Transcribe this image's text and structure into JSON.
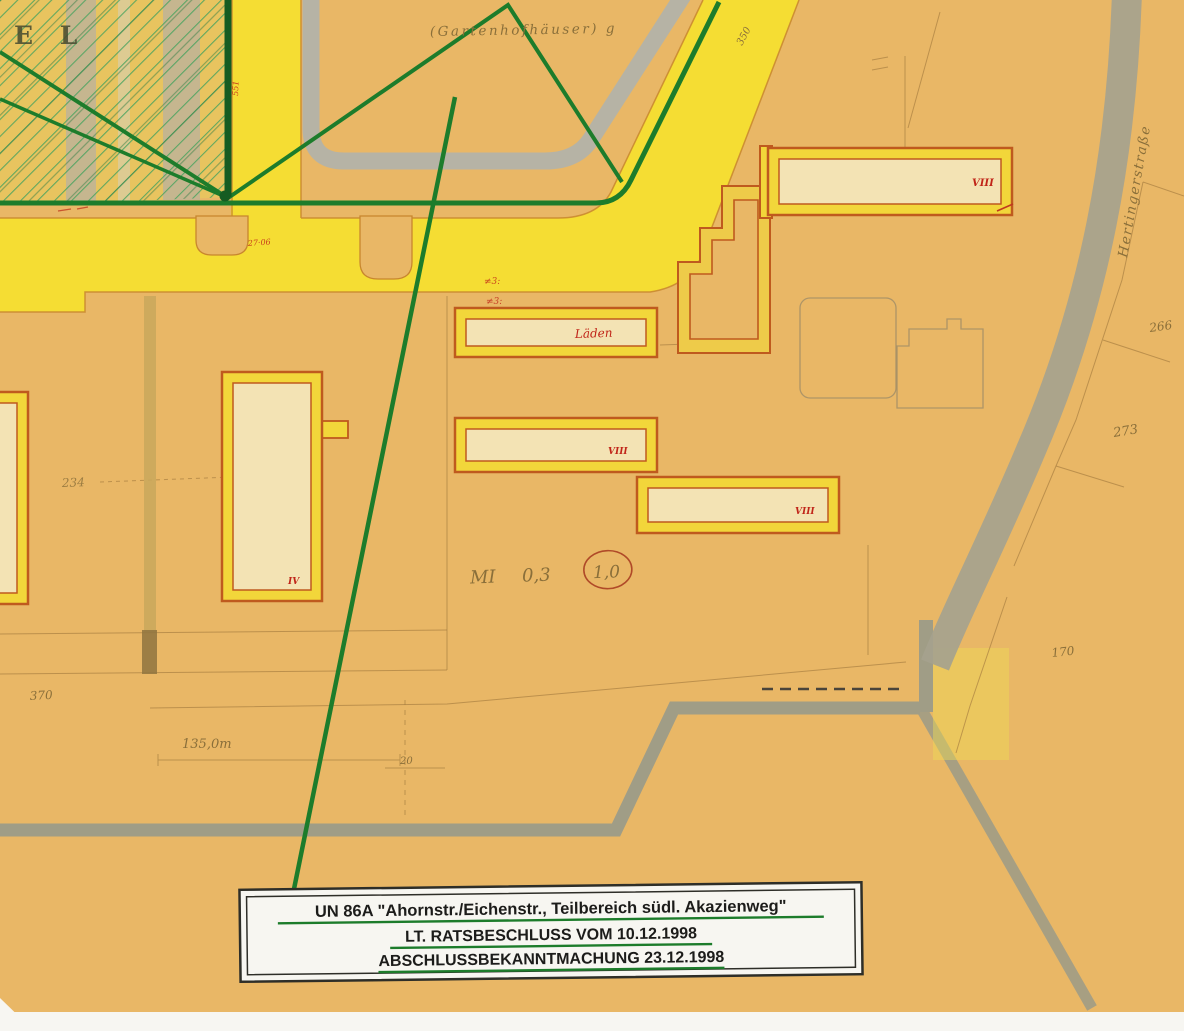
{
  "map": {
    "background": "#e9b766",
    "road_color": "#f5dd33",
    "green_line_color": "#1d7c2b",
    "gray_band_color": "#b6b3a5",
    "boundary_color": "#a09d86",
    "building_outline_color": "#bf5a1e",
    "building_band_color": "#f2d63a",
    "building_fill_color": "#f3e3b4",
    "corner_letters": "E L",
    "center_plot_label": "(Gartenhofhäuser) g",
    "street_name": "Hertingerstraße",
    "zoning": {
      "mi": "MI",
      "ratio": "0,3",
      "circled": "1,0"
    },
    "building_labels": {
      "b1": "VIII",
      "laden": "Läden",
      "b4": "VIII",
      "b5": "VIII",
      "b6": "IV"
    },
    "annotations": {
      "a551": "551",
      "a350": "350",
      "a2706": "27·06",
      "hash1": "≠3:",
      "hash2": "≠3:",
      "a370": "370",
      "a234": "234",
      "a135": "135,0m",
      "a20": "20",
      "a170": "170",
      "a273": "273",
      "a266": "266"
    },
    "title_box": {
      "line1": "UN 86A \"Ahornstr./Eichenstr., Teilbereich südl. Akazienweg\"",
      "line2": "LT. RATSBESCHLUSS VOM 10.12.1998",
      "line3": "ABSCHLUSSBEKANNTMACHUNG 23.12.1998"
    }
  }
}
